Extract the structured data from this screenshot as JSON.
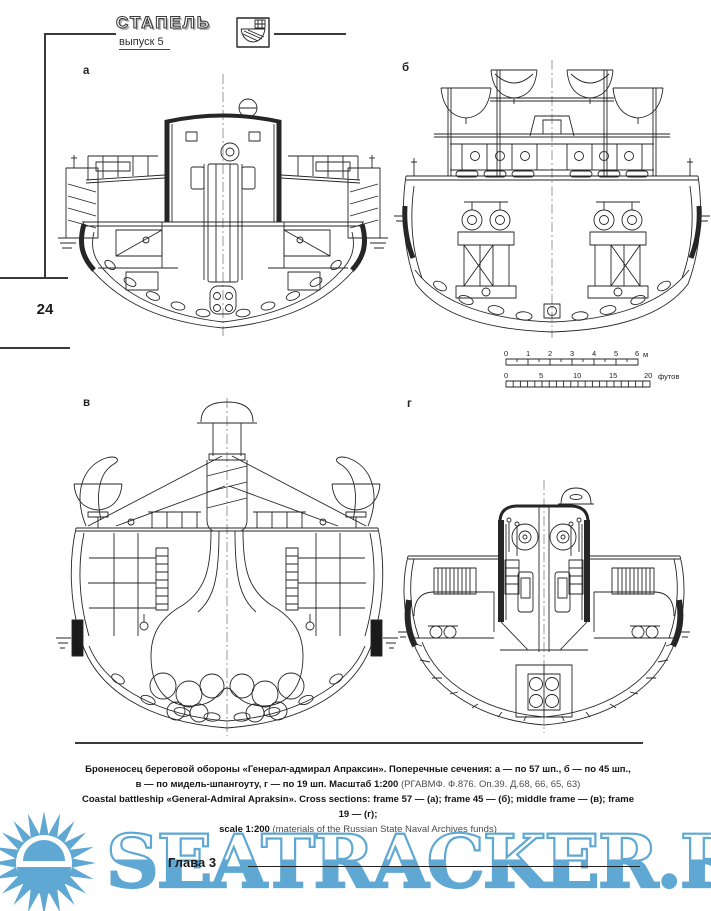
{
  "header": {
    "brand": "СТАПЕЛЬ",
    "issue": "выпуск 5"
  },
  "page": {
    "number": "24",
    "chapter": "Глава 3"
  },
  "figure": {
    "labels": {
      "a": "а",
      "b": "б",
      "v": "в",
      "g": "г"
    },
    "scalebar": {
      "meters": {
        "ticks": [
          "0",
          "1",
          "2",
          "3",
          "4",
          "5",
          "6"
        ],
        "unit": "м"
      },
      "feet": {
        "ticks": [
          "0",
          "5",
          "10",
          "15",
          "20"
        ],
        "unit": "футов"
      }
    },
    "caption": {
      "line1": "Броненосец береговой обороны «Генерал-адмирал Апраксин». Поперечные сечения: а — по 57 шп., б — по 45 шп.,",
      "line2_bold": "в — по мидель-шпангоуту, г — по 19 шп. Масштаб 1:200",
      "line2_note": " (РГАВМФ. Ф.876. Оп.39. Д.68, 66, 65, 63)",
      "line3": "Coastal battleship «General-Admiral Apraksin». Cross sections:  frame 57 — (а);   frame 45 — (б);  middle frame — (в);  frame 19 — (г);",
      "line4_bold": "scale 1:200",
      "line4_note": " (materials of the Russian State Naval Archives funds)"
    }
  },
  "watermark": {
    "text": "SEATRACKER.RU",
    "color": "#5fa8d3"
  }
}
